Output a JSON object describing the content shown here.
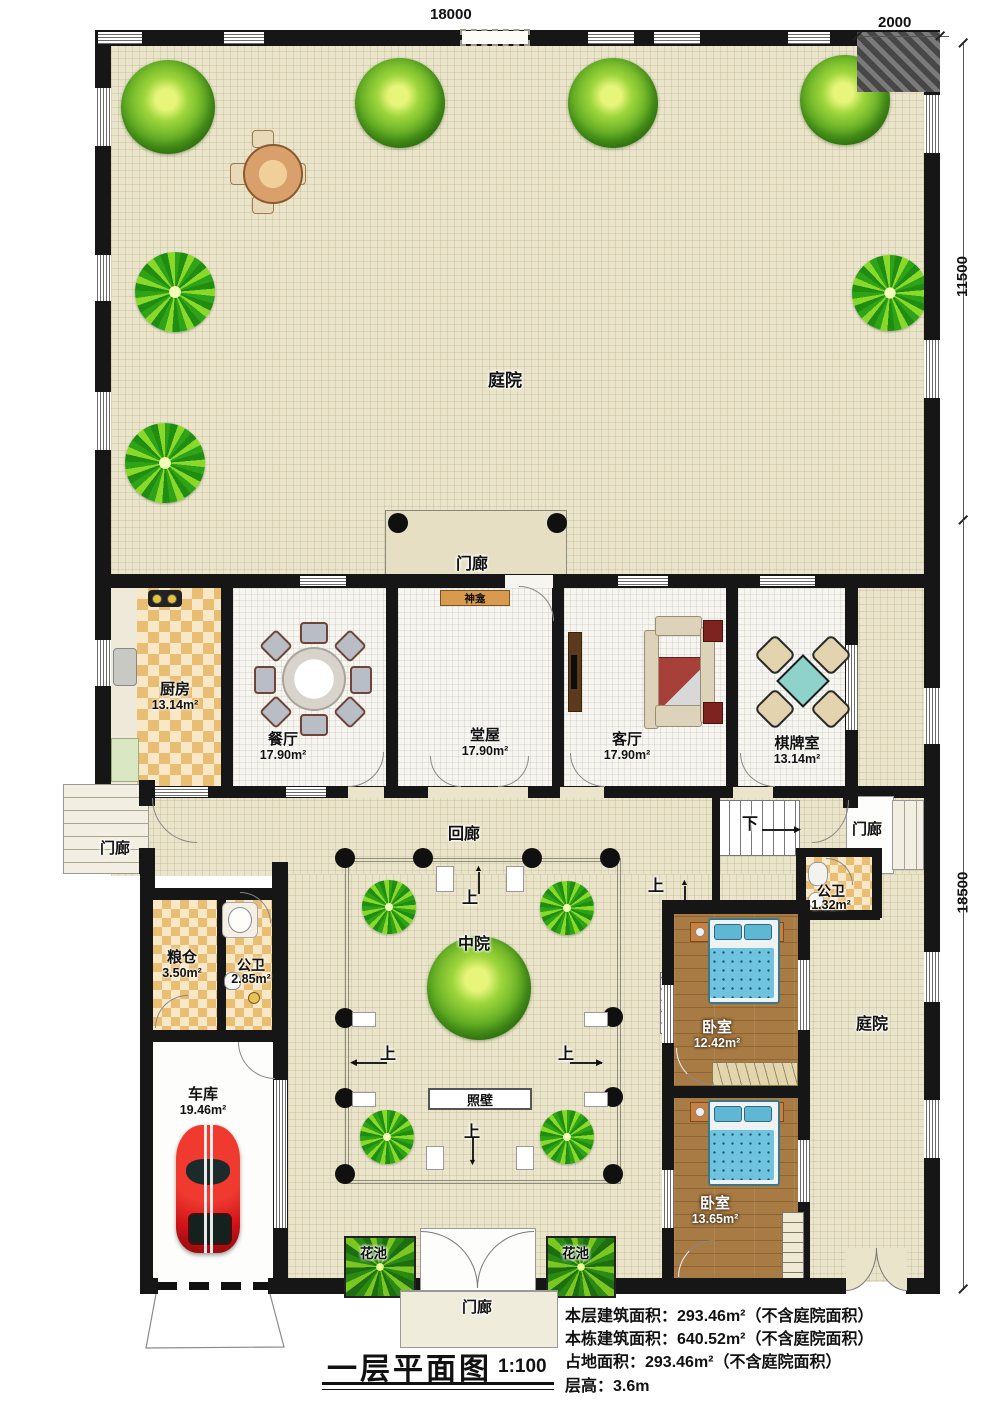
{
  "title": {
    "name": "一层平面图",
    "scale": "1:100"
  },
  "dimensions": {
    "top_width": "18000",
    "top_right_width": "2000",
    "right_height_upper": "11500",
    "right_height_lower": "18500"
  },
  "info": {
    "floor_area": "本层建筑面积：293.46m²（不含庭院面积）",
    "building_area": "本栋建筑面积：640.52m²（不含庭院面积）",
    "footprint_area": "占地面积：293.46m²（不含庭院面积）",
    "floor_height": "层高：3.6m"
  },
  "rooms": {
    "courtyard_top": {
      "label": "庭院"
    },
    "courtyard_right": {
      "label": "庭院"
    },
    "porch_top": {
      "label": "门廊"
    },
    "porch_left": {
      "label": "门廊"
    },
    "porch_right": {
      "label": "门廊"
    },
    "porch_bottom": {
      "label": "门廊"
    },
    "kitchen": {
      "label": "厨房",
      "area": "13.14m²"
    },
    "dining": {
      "label": "餐厅",
      "area": "17.90m²"
    },
    "hall": {
      "label": "堂屋",
      "area": "17.90m²"
    },
    "living": {
      "label": "客厅",
      "area": "17.90m²"
    },
    "chess": {
      "label": "棋牌室",
      "area": "13.14m²"
    },
    "shrine": {
      "label": "神龛"
    },
    "cloister": {
      "label": "回廊"
    },
    "bath_right": {
      "label": "公卫",
      "area": "1.32m²"
    },
    "granary": {
      "label": "粮仓",
      "area": "3.50m²"
    },
    "bath_left": {
      "label": "公卫",
      "area": "2.85m²"
    },
    "garage": {
      "label": "车库",
      "area": "19.46m²"
    },
    "middle_court": {
      "label": "中院"
    },
    "screen_wall": {
      "label": "照壁"
    },
    "bedroom_upper": {
      "label": "卧室",
      "area": "12.42m²"
    },
    "bedroom_lower": {
      "label": "卧室",
      "area": "13.65m²"
    },
    "flower_left": {
      "label": "花池"
    },
    "flower_right": {
      "label": "花池"
    }
  },
  "stairs": {
    "up": "上",
    "down": "下"
  },
  "colors": {
    "wall": "#161616",
    "courtyard_floor": "#eae4cb",
    "room_floor": "#f6f5f0",
    "checker": "#e9bd72",
    "wood_floor": "#a87b45",
    "bed": "#6fc3de",
    "mahjong_table": "#8fd2cc",
    "car": "#cf1318",
    "tree": "#53a21d",
    "shrine_cabinet": "#d79a4e",
    "rug": "#8e3030"
  }
}
